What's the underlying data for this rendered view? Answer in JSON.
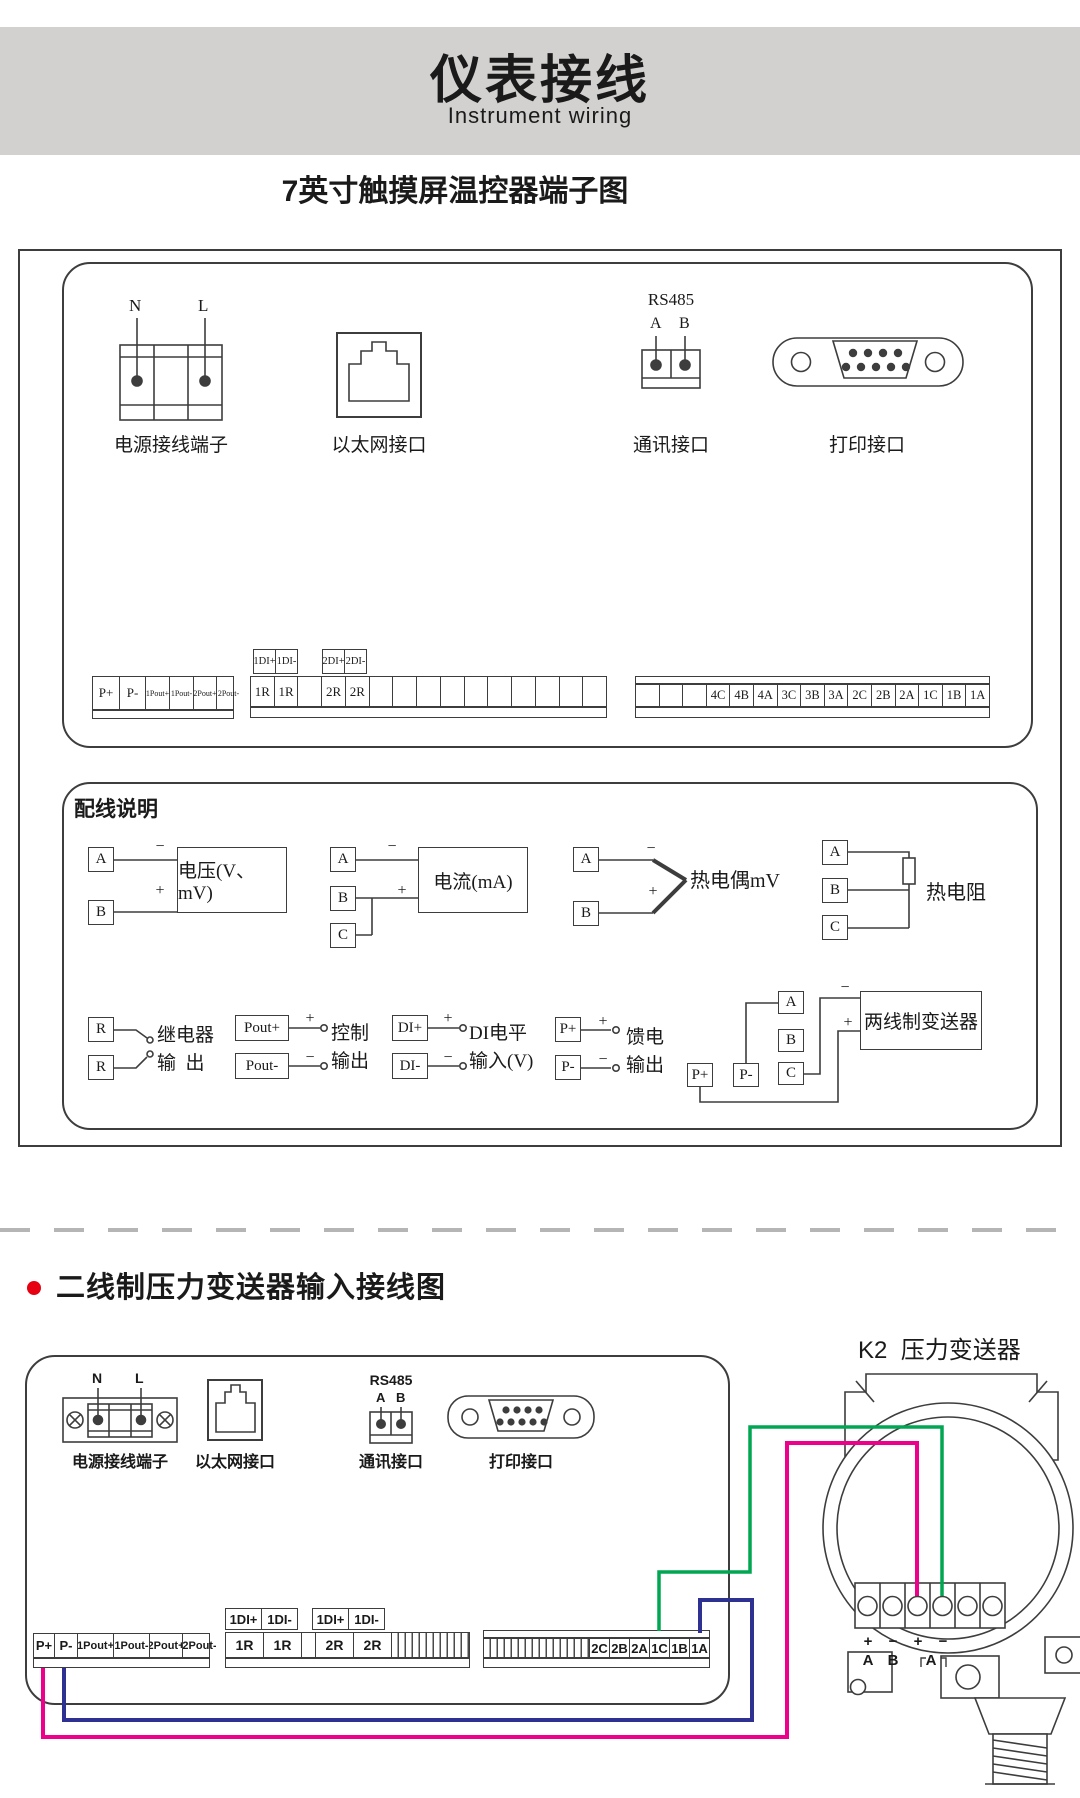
{
  "signs": {
    "plus": "+",
    "minus": "−"
  },
  "header": {
    "title": "仪表接线",
    "subtitle": "Instrument wiring"
  },
  "s1": {
    "title": "7英寸触摸屏温控器端子图",
    "power": {
      "label": "电源接线端子",
      "pin_n": "N",
      "pin_l": "L"
    },
    "ethernet": {
      "label": "以太网接口"
    },
    "rs485": {
      "name": "RS485",
      "pin_a": "A",
      "pin_b": "B",
      "label": "通讯接口"
    },
    "printer": {
      "label": "打印接口"
    },
    "strips": {
      "left": [
        "P+",
        "P-",
        "1Pout+",
        "1Pout-",
        "2Pout+",
        "2Pout-"
      ],
      "di1": [
        "1DI+",
        "1DI-"
      ],
      "di2": [
        "2DI+",
        "2DI-"
      ],
      "middle": [
        "1R",
        "1R",
        "",
        "2R",
        "2R",
        "",
        "",
        "",
        "",
        "",
        "",
        "",
        "",
        "",
        ""
      ],
      "right": [
        "",
        "",
        "",
        "4C",
        "4B",
        "4A",
        "3C",
        "3B",
        "3A",
        "2C",
        "2B",
        "2A",
        "1C",
        "1B",
        "1A"
      ]
    },
    "wiring": {
      "title": "配线说明",
      "voltage": {
        "a": "A",
        "b": "B",
        "label": "电压(V、mV)"
      },
      "current": {
        "a": "A",
        "b": "B",
        "c": "C",
        "label": "电流(mA)"
      },
      "tc": {
        "a": "A",
        "b": "B",
        "label": "热电偶mV"
      },
      "rtd": {
        "a": "A",
        "b": "B",
        "c": "C",
        "label": "热电阻"
      },
      "relay": {
        "r1": "R",
        "r2": "R",
        "line1": "继电器",
        "line2": "输  出"
      },
      "control": {
        "t1": "Pout+",
        "t2": "Pout-",
        "line1": "控制",
        "line2": "输出"
      },
      "di": {
        "t1": "DI+",
        "t2": "DI-",
        "line1": "DI电平",
        "line2": "输入(V)"
      },
      "feed": {
        "t1": "P+",
        "t2": "P-",
        "line1": "馈电",
        "line2": "输出"
      },
      "twowire": {
        "a": "A",
        "b": "B",
        "c": "C",
        "p1": "P+",
        "p2": "P-",
        "label": "两线制变送器"
      }
    }
  },
  "s2": {
    "title": "二线制压力变送器输入接线图",
    "k2_label": "K2  压力变送器",
    "power": {
      "label": "电源接线端子",
      "pin_n": "N",
      "pin_l": "L"
    },
    "ethernet": {
      "label": "以太网接口"
    },
    "rs485": {
      "name": "RS485",
      "pin_a": "A",
      "pin_b": "B",
      "label": "通讯接口"
    },
    "printer": {
      "label": "打印接口"
    },
    "strips": {
      "left": [
        "P+",
        "P-",
        "1Pout+",
        "1Pout-",
        "2Pout+",
        "2Pout-"
      ],
      "di1": [
        "1DI+",
        "1DI-"
      ],
      "di2": [
        "1DI+",
        "1DI-"
      ],
      "middle": [
        "1R",
        "1R",
        "",
        "2R",
        "2R"
      ],
      "right": [
        "2C",
        "2B",
        "2A",
        "1C",
        "1B",
        "1A"
      ]
    },
    "transmitter": {
      "pol1": "+",
      "pol2": "−",
      "pol3": "+",
      "pol4": "−",
      "pin1": "A",
      "pin2": "B",
      "pin3": "A"
    },
    "wire_colors": {
      "pink": "#ec008c",
      "blue": "#2e3192",
      "green": "#00a651"
    }
  }
}
